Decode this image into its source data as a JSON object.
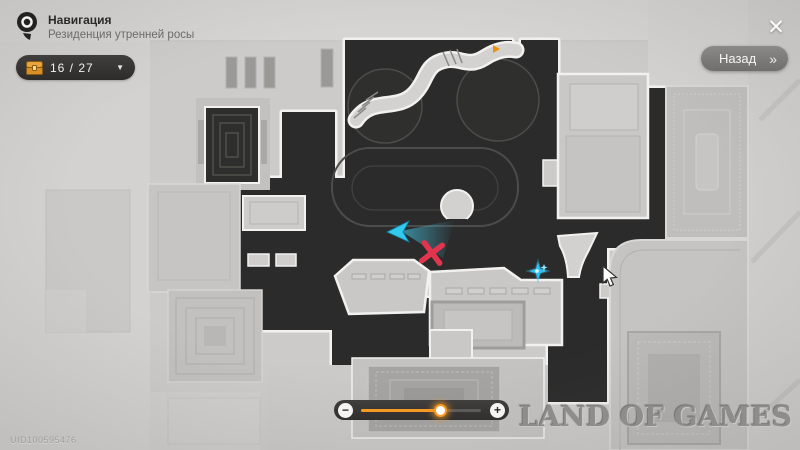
{
  "header": {
    "title": "Навигация",
    "subtitle": "Резиденция утренней росы"
  },
  "chest_counter": {
    "count": "16 / 27"
  },
  "back_button": {
    "label": "Назад",
    "chevron": "»"
  },
  "icons": {
    "close": "✕",
    "dropdown": "▼",
    "slider_minus": "−",
    "slider_plus": "+",
    "pin": "location-pin-icon",
    "chest": "treasure-chest-icon"
  },
  "slider": {
    "value_pct": 66,
    "accent_color": "#f59a23"
  },
  "markers": {
    "player_color": "#35c9ee",
    "destination_color": "#e3344e",
    "sparkle_color": "#2ec1f2",
    "flag_color": "#e8930f"
  },
  "map_colors": {
    "dark_region": "#2b2b2b",
    "outline": "#f2f1ef",
    "base": "#d2d1cf"
  },
  "watermarks": {
    "brand": "LAND OF GAMES",
    "uid": "UID100595476"
  }
}
